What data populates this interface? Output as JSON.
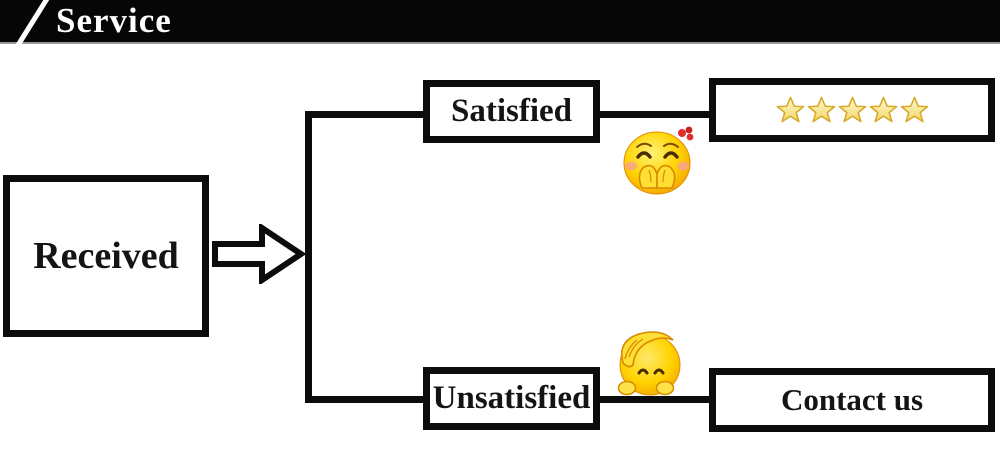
{
  "header": {
    "title": "Service"
  },
  "flow": {
    "received_label": "Received",
    "satisfied_label": "Satisfied",
    "unsatisfied_label": "Unsatisfied",
    "contact_label": "Contact us",
    "rating_stars": 5
  },
  "icons": {
    "header_slash": "diagonal-slash",
    "arrow": "right-block-arrow",
    "satisfied_emoji": "giggling-face-with-red-flower",
    "unsatisfied_emoji": "shy-face-hand-on-head",
    "star": "gold-star"
  },
  "colors": {
    "header_bg": "#060606",
    "header_text": "#ffffff",
    "line_black": "#0c0c0c",
    "emoji_yellow": "#ffd300",
    "star_fill": "#f8ef9e",
    "star_stroke": "#d8a829"
  }
}
